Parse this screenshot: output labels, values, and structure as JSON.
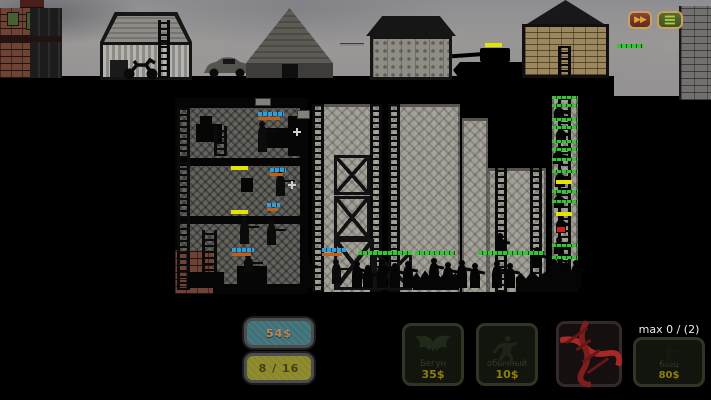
{
  "top_bar": {
    "fast_forward_icon": "▶▶",
    "menu_icon": "≡"
  },
  "hud": {
    "money": "54$",
    "capacity": "8 / 16",
    "max_counter": "max 0 / (2)"
  },
  "shop": {
    "units": [
      {
        "label": "Бегун",
        "cost": "35$",
        "icon": "bat-icon"
      },
      {
        "label": "обычный",
        "cost": "10$",
        "icon": "runner-icon"
      },
      {
        "label": "",
        "cost": "",
        "icon": "dna-icon"
      },
      {
        "label": "боец",
        "cost": "80$",
        "icon": "soldier-icon"
      }
    ]
  },
  "colors": {
    "hp_green": "#35c435",
    "hp_cyan": "#2f9fd8",
    "hp_orange": "#c06018",
    "hp_yellow": "#e4e400",
    "hp_red": "#cc2020",
    "money_panel": "#3f7179",
    "capacity_panel": "#8f8d2e",
    "cost_text": "#8f7f0a",
    "dna_red": "#a82828",
    "ff_button": "#6a3020",
    "menu_button": "#4a5a28"
  },
  "scene": {
    "masses": [
      [
        413,
        268,
        46,
        22
      ],
      [
        516,
        268,
        62,
        24
      ]
    ],
    "zombies": [
      [
        303,
        262,
        26
      ],
      [
        352,
        266,
        22
      ],
      [
        363,
        270,
        18
      ],
      [
        377,
        264,
        24
      ],
      [
        390,
        268,
        20
      ],
      [
        403,
        266,
        22
      ],
      [
        429,
        263,
        25
      ],
      [
        443,
        267,
        21
      ],
      [
        457,
        265,
        23
      ],
      [
        470,
        268,
        20
      ],
      [
        492,
        266,
        22
      ],
      [
        505,
        268,
        20
      ],
      [
        549,
        264,
        24
      ],
      [
        561,
        267,
        21
      ],
      [
        571,
        265,
        23
      ],
      [
        554,
        108,
        12
      ],
      [
        556,
        130,
        13
      ],
      [
        553,
        152,
        12
      ],
      [
        555,
        174,
        13
      ],
      [
        554,
        196,
        12
      ],
      [
        556,
        220,
        13
      ],
      [
        554,
        242,
        12
      ],
      [
        555,
        262,
        13
      ],
      [
        495,
        238,
        16
      ],
      [
        532,
        252,
        16
      ]
    ],
    "soldiers": [
      [
        258,
        126,
        26
      ],
      [
        276,
        176,
        20
      ],
      [
        240,
        222,
        22
      ],
      [
        267,
        225,
        20
      ],
      [
        244,
        258,
        14
      ],
      [
        332,
        264,
        20
      ]
    ],
    "flashes": [
      [
        293,
        128
      ],
      [
        288,
        181
      ]
    ],
    "bars": [
      {
        "x": 485,
        "y": 43,
        "w": 17,
        "h": 4,
        "c": "yellow"
      },
      {
        "x": 617,
        "y": 44,
        "w": 26,
        "h": 4,
        "c": "green"
      },
      {
        "x": 258,
        "y": 112,
        "w": 26,
        "h": 4,
        "c": "cyan"
      },
      {
        "x": 258,
        "y": 117,
        "w": 22,
        "h": 3,
        "c": "orange"
      },
      {
        "x": 231,
        "y": 166,
        "w": 17,
        "h": 4,
        "c": "yellow"
      },
      {
        "x": 270,
        "y": 168,
        "w": 16,
        "h": 4,
        "c": "cyan"
      },
      {
        "x": 270,
        "y": 173,
        "w": 13,
        "h": 3,
        "c": "orange"
      },
      {
        "x": 231,
        "y": 210,
        "w": 17,
        "h": 4,
        "c": "yellow"
      },
      {
        "x": 267,
        "y": 203,
        "w": 13,
        "h": 4,
        "c": "cyan"
      },
      {
        "x": 267,
        "y": 208,
        "w": 11,
        "h": 3,
        "c": "orange"
      },
      {
        "x": 232,
        "y": 248,
        "w": 22,
        "h": 4,
        "c": "cyan"
      },
      {
        "x": 232,
        "y": 253,
        "w": 19,
        "h": 3,
        "c": "orange"
      },
      {
        "x": 322,
        "y": 248,
        "w": 24,
        "h": 4,
        "c": "cyan"
      },
      {
        "x": 322,
        "y": 253,
        "w": 20,
        "h": 3,
        "c": "orange"
      },
      {
        "x": 358,
        "y": 251,
        "w": 54,
        "h": 4,
        "c": "green"
      },
      {
        "x": 415,
        "y": 251,
        "w": 40,
        "h": 4,
        "c": "green"
      },
      {
        "x": 478,
        "y": 251,
        "w": 50,
        "h": 4,
        "c": "green"
      },
      {
        "x": 524,
        "y": 251,
        "w": 20,
        "h": 4,
        "c": "green"
      },
      {
        "x": 552,
        "y": 96,
        "w": 26,
        "h": 3,
        "c": "green"
      },
      {
        "x": 552,
        "y": 104,
        "w": 26,
        "h": 3,
        "c": "green"
      },
      {
        "x": 552,
        "y": 118,
        "w": 26,
        "h": 3,
        "c": "green"
      },
      {
        "x": 552,
        "y": 126,
        "w": 26,
        "h": 3,
        "c": "green"
      },
      {
        "x": 552,
        "y": 140,
        "w": 26,
        "h": 3,
        "c": "green"
      },
      {
        "x": 552,
        "y": 148,
        "w": 26,
        "h": 3,
        "c": "green"
      },
      {
        "x": 552,
        "y": 158,
        "w": 26,
        "h": 3,
        "c": "green"
      },
      {
        "x": 552,
        "y": 170,
        "w": 26,
        "h": 3,
        "c": "green"
      },
      {
        "x": 556,
        "y": 180,
        "w": 16,
        "h": 4,
        "c": "yellow"
      },
      {
        "x": 552,
        "y": 190,
        "w": 26,
        "h": 3,
        "c": "green"
      },
      {
        "x": 552,
        "y": 200,
        "w": 26,
        "h": 3,
        "c": "green"
      },
      {
        "x": 556,
        "y": 212,
        "w": 16,
        "h": 4,
        "c": "yellow"
      },
      {
        "x": 557,
        "y": 227,
        "w": 8,
        "h": 5,
        "c": "red"
      },
      {
        "x": 552,
        "y": 244,
        "w": 26,
        "h": 3,
        "c": "green"
      },
      {
        "x": 552,
        "y": 256,
        "w": 26,
        "h": 3,
        "c": "green"
      }
    ]
  }
}
